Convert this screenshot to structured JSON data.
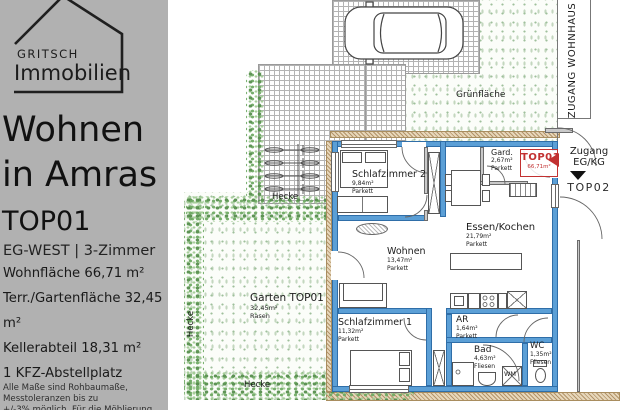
{
  "panel": {
    "brand": {
      "top": "GRITSCH",
      "bottom": "Immobilien"
    },
    "title": [
      "Wohnen",
      "in Amras"
    ],
    "unit": "TOP01",
    "subtitle": "EG-WEST | 3-Zimmer",
    "facts": [
      "Wohnfläche 66,71 m²",
      "Terr./Gartenfläche 32,45 m²",
      "Kellerabteil 18,31 m²",
      "1 KFZ-Abstellplatz"
    ],
    "disclaimer": [
      "Alle Maße sind Rohbaumaße, Messtoleranzen bis zu",
      "+/-3% möglich. Für die Möblierung Naturmaße"
    ]
  },
  "plan": {
    "rooms": [
      {
        "name": "Schlafzimmer 2",
        "area": "9,84m²",
        "floor": "Parkett"
      },
      {
        "name": "Gard.",
        "area": "2,67m²",
        "floor": "Parkett"
      },
      {
        "name": "Essen/Kochen",
        "area": "21,79m²",
        "floor": "Parkett"
      },
      {
        "name": "Wohnen",
        "area": "13,47m²",
        "floor": "Parkett"
      },
      {
        "name": "Schlafzimmer 1",
        "area": "11,32m²",
        "floor": "Parkett"
      },
      {
        "name": "AR",
        "area": "1,64m²",
        "floor": "Parkett"
      },
      {
        "name": "Bad",
        "area": "4,63m²",
        "floor": "Fliesen"
      },
      {
        "name": "WC",
        "area": "1,35m²",
        "floor": "Fliesen"
      }
    ],
    "unit_tag": {
      "label": "TOP01",
      "area": "66,71m²"
    },
    "garden": {
      "name": "Garten TOP01",
      "area": "32,45m²",
      "surface": "Rasen"
    },
    "green_area": "Grünfläche",
    "hedge": "Hecke",
    "washer": "WM",
    "access": {
      "house_entrance": "ZUGANG WOHNHAUS",
      "entry": [
        "Zugang",
        "EG/KG"
      ],
      "neighbor_unit": "TOP02"
    }
  },
  "colors": {
    "panel_bg": "#b1b1b1",
    "unit_wall": "#5b9fd6",
    "insulation": "#e7d7ba",
    "accent_red": "#c23131",
    "hedge": "#6faa64"
  }
}
